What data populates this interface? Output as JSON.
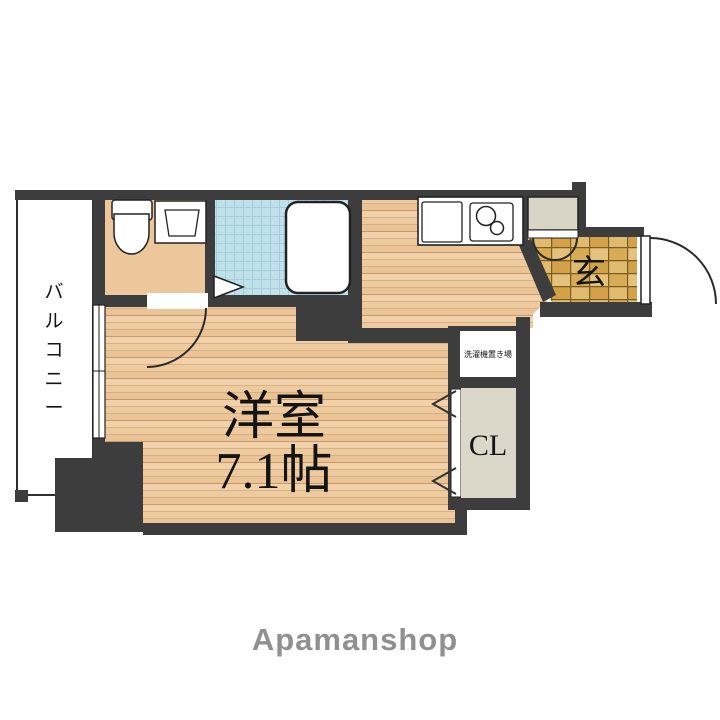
{
  "plan": {
    "brand": "Apamanshop",
    "rooms": {
      "main_room": {
        "name": "洋室",
        "size": "7.1帖"
      },
      "balcony": {
        "label": "バルコニー"
      },
      "entrance": {
        "label": "玄"
      },
      "closet": {
        "label": "CL"
      },
      "laundry": {
        "label": "洗濯機置き場"
      }
    },
    "fixtures": [
      "toilet-icon",
      "washbasin-icon",
      "bathtub-icon",
      "kitchen-sink-icon",
      "stove-burners-icon",
      "entrance-door-swing-icon",
      "room-door-swing-icon",
      "bathroom-folding-door-icon",
      "closet-folding-door-icon",
      "balcony-window-icon",
      "shoe-cabinet-icon",
      "washer-space-box"
    ],
    "colors": {
      "wall": "#3d3d3d",
      "wood_floor": "#eecb9f",
      "bath_tile": "#c0e0ea",
      "entrance_tile": "#d8ac57",
      "closet_fill": "#dcd8c9",
      "cabinet_fill": "#d9d5c6",
      "brand_text": "#909090",
      "label_text": "#141414",
      "background": "#ffffff"
    }
  }
}
